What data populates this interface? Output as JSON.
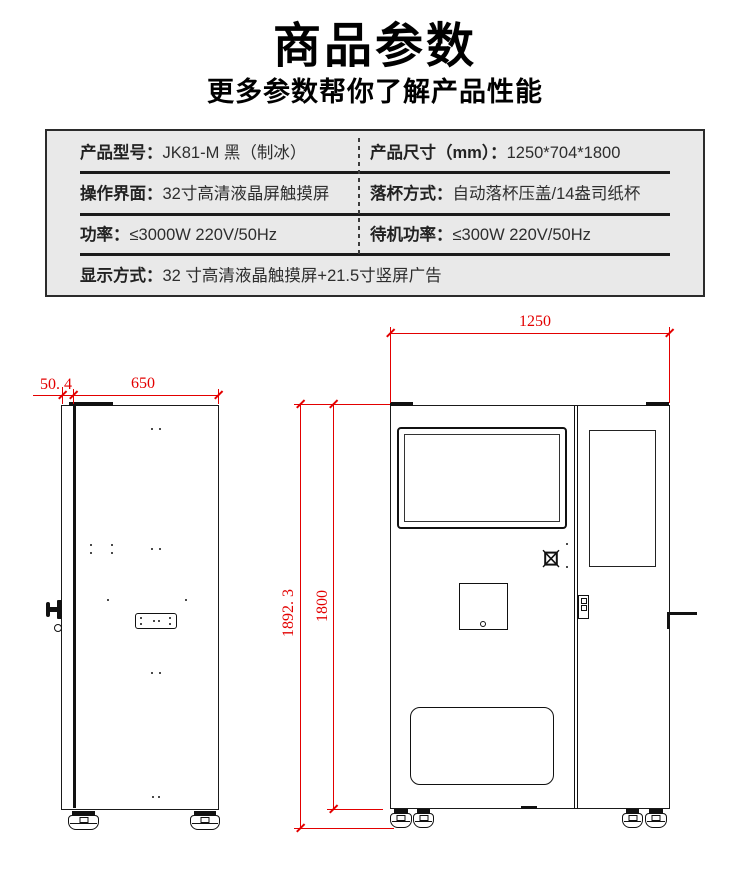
{
  "header": {
    "title": "商品参数",
    "subtitle": "更多参数帮你了解产品性能"
  },
  "spec_table": {
    "rows": [
      {
        "cells": [
          {
            "label": "产品型号：",
            "value": "JK81-M 黑（制冰）"
          },
          {
            "label": "产品尺寸（mm）：",
            "value": "1250*704*1800"
          }
        ]
      },
      {
        "cells": [
          {
            "label": "操作界面：",
            "value": "32寸高清液晶屏触摸屏"
          },
          {
            "label": "落杯方式：",
            "value": "自动落杯压盖/14盎司纸杯"
          }
        ]
      },
      {
        "cells": [
          {
            "label": "功率：",
            "value": "≤3000W 220V/50Hz"
          },
          {
            "label": "待机功率：",
            "value": "≤300W 220V/50Hz"
          }
        ]
      },
      {
        "cells": [
          {
            "label": "显示方式：",
            "value": "32 寸高清液晶触摸屏+21.5寸竖屏广告"
          }
        ]
      }
    ]
  },
  "drawing": {
    "side_view": {
      "door_offset_depth": "50. 4",
      "body_depth": "650"
    },
    "front_view": {
      "overall_width": "1250",
      "overall_height": "1892. 3",
      "cabinet_height": "1800"
    },
    "colors": {
      "dimension_red": "#e30000",
      "line_black": "#1a1a1a",
      "table_background": "#e9e9e9"
    }
  }
}
